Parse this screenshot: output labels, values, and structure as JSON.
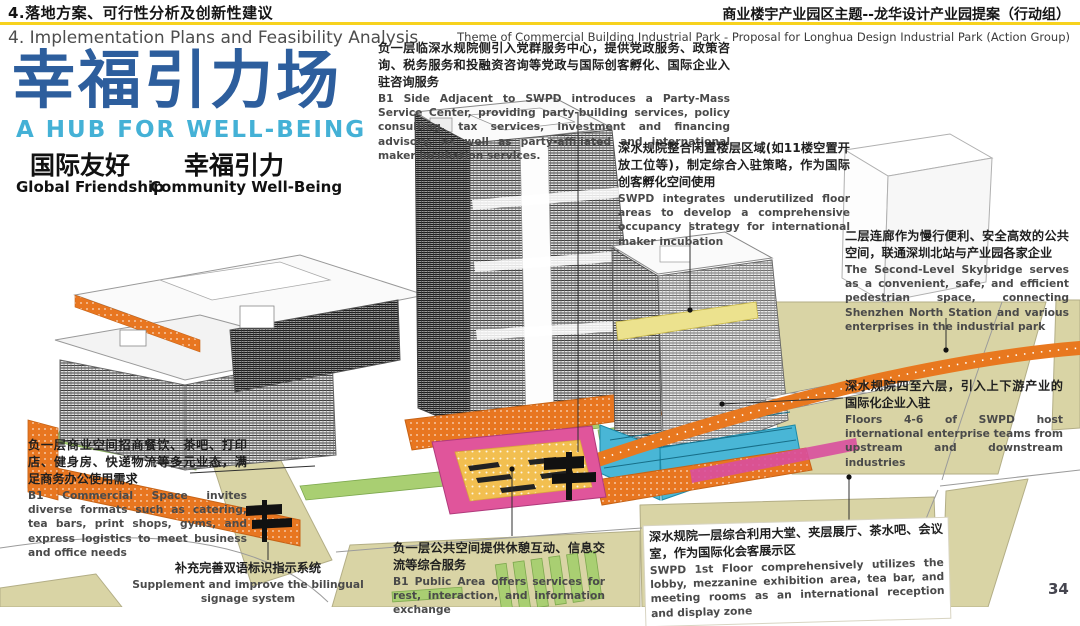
{
  "header": {
    "zh_title": "4.落地方案、可行性分析及创新性建议",
    "en_title": "4. Implementation Plans and Feasibility Analysis",
    "zh_right": "商业楼宇产业园区主题--龙华设计产业园提案（行动组）",
    "en_right": "Theme of Commercial Building Industrial Park - Proposal for Longhua Design Industrial Park (Action Group)"
  },
  "hero": {
    "zh_title": "幸福引力场",
    "en_title": "A HUB FOR WELL-BEING",
    "pillars": [
      {
        "zh": "国际友好",
        "en": "Global Friendship"
      },
      {
        "zh": "幸福引力",
        "en": "Community Well-Being"
      }
    ]
  },
  "callouts": {
    "b1_party_mass": {
      "zh": "负一层临深水规院侧引入党群服务中心，提供党政服务、政策咨询、税务服务和投融资咨询等党政与国际创客孵化、国际企业入驻咨询服务",
      "en": "B1 Side Adjacent to SWPD introduces a Party-Mass Service Center, providing party-building services, policy consulting, tax services, investment and financing advisory, as well as party-affiliated and international maker incubation services."
    },
    "floor_integration": {
      "zh": "深水规院整合闲置楼层区域(如11楼空置开放工位等)，制定综合入驻策略，作为国际创客孵化空间使用",
      "en": "SWPD integrates underutilized floor areas to develop a comprehensive occupancy strategy for international maker incubation"
    },
    "skybridge": {
      "zh": "二层连廊作为慢行便利、安全高效的公共空间，联通深圳北站与产业园各家企业",
      "en": "The Second-Level Skybridge serves as a convenient, safe, and efficient pedestrian space, connecting Shenzhen North Station and various enterprises in the industrial park"
    },
    "floors_4_6": {
      "zh": "深水规院四至六层，引入上下游产业的国际化企业入驻",
      "en": "Floors 4-6 of SWPD host international enterprise teams from upstream and downstream industries"
    },
    "b1_commercial": {
      "zh": "负一层商业空间招商餐饮、茶吧、打印店、健身房、快递物流等多元业态，满足商务办公使用需求",
      "en": "B1 Commercial Space invites diverse formats such as catering, tea bars, print shops, gyms, and express logistics to meet business and office needs"
    },
    "b1_public": {
      "zh": "负一层公共空间提供休憩互动、信息交流等综合服务",
      "en": "B1 Public Area offers services for rest, interaction, and information exchange"
    },
    "first_floor": {
      "zh": "深水规院一层综合利用大堂、夹层展厅、茶水吧、会议室，作为国际化会客展示区",
      "en": "SWPD 1st Floor comprehensively utilizes the lobby, mezzanine exhibition area, tea bar, and meeting rooms as an international reception and display zone"
    },
    "signage": {
      "zh": "补充完善双语标识指示系统",
      "en": "Supplement and improve the bilingual signage system"
    }
  },
  "page_number": "34",
  "colors": {
    "title_blue": "#2d5e9d",
    "subtitle_cyan": "#44b1d6",
    "rule_yellow": "#f7d21e",
    "accent_orange": "#e87620",
    "ground_olive": "#d9d4a5",
    "vegetation_green": "#a9cf72",
    "highlight_cyan": "#49b6d6",
    "highlight_magenta": "#e0559b",
    "highlight_yellow": "#f2bf50"
  }
}
